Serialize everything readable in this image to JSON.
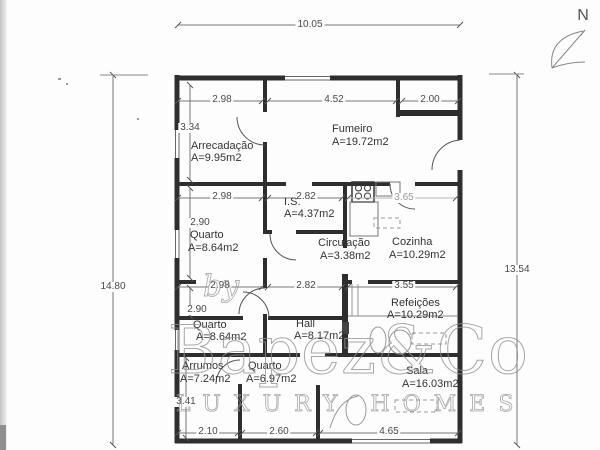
{
  "compass": {
    "label": "N"
  },
  "dimensions": {
    "overall_top": "10.05",
    "overall_left": "14.80",
    "overall_right": "13.54",
    "top": [
      "2.98",
      "4.52",
      "2.00"
    ],
    "mid": [
      "2.98",
      "2.82",
      "3.65"
    ],
    "lower": [
      "2.98",
      "2.82",
      "3.55"
    ],
    "left_col": [
      "3.34",
      "2.90",
      "2.90",
      "3.41"
    ],
    "bottom": [
      "2.10",
      "2.60",
      "4.65"
    ]
  },
  "rooms": {
    "arrecadacao": {
      "name": "Arrecadação",
      "area": "A=9.95m2"
    },
    "fumeiro": {
      "name": "Fumeiro",
      "area": "A=19.72m2"
    },
    "is": {
      "name": "I.S.",
      "area": "A=4.37m2"
    },
    "quarto1": {
      "name": "Quarto",
      "area": "A=8.64m2"
    },
    "circulacao": {
      "name": "Circulação",
      "area": "A=3.38m2"
    },
    "cozinha": {
      "name": "Cozinha",
      "area": "A=10.29m2"
    },
    "quarto2": {
      "name": "Quarto",
      "area": "A=8.64m2"
    },
    "hall": {
      "name": "Hall",
      "area": "A=8.17m2"
    },
    "refeicoes": {
      "name": "Refeições",
      "area": "A=10.29m2"
    },
    "arrumos": {
      "name": "Arrumos",
      "area": "A=7.24m2"
    },
    "quarto3": {
      "name": "Quarto",
      "area": "A=6.97m2"
    },
    "sala": {
      "name": "Sala",
      "area": "A=16.03m2"
    }
  },
  "watermark": {
    "by": "by",
    "brand": "Bapez&Co",
    "tagline": "LUXURY HOMES"
  }
}
